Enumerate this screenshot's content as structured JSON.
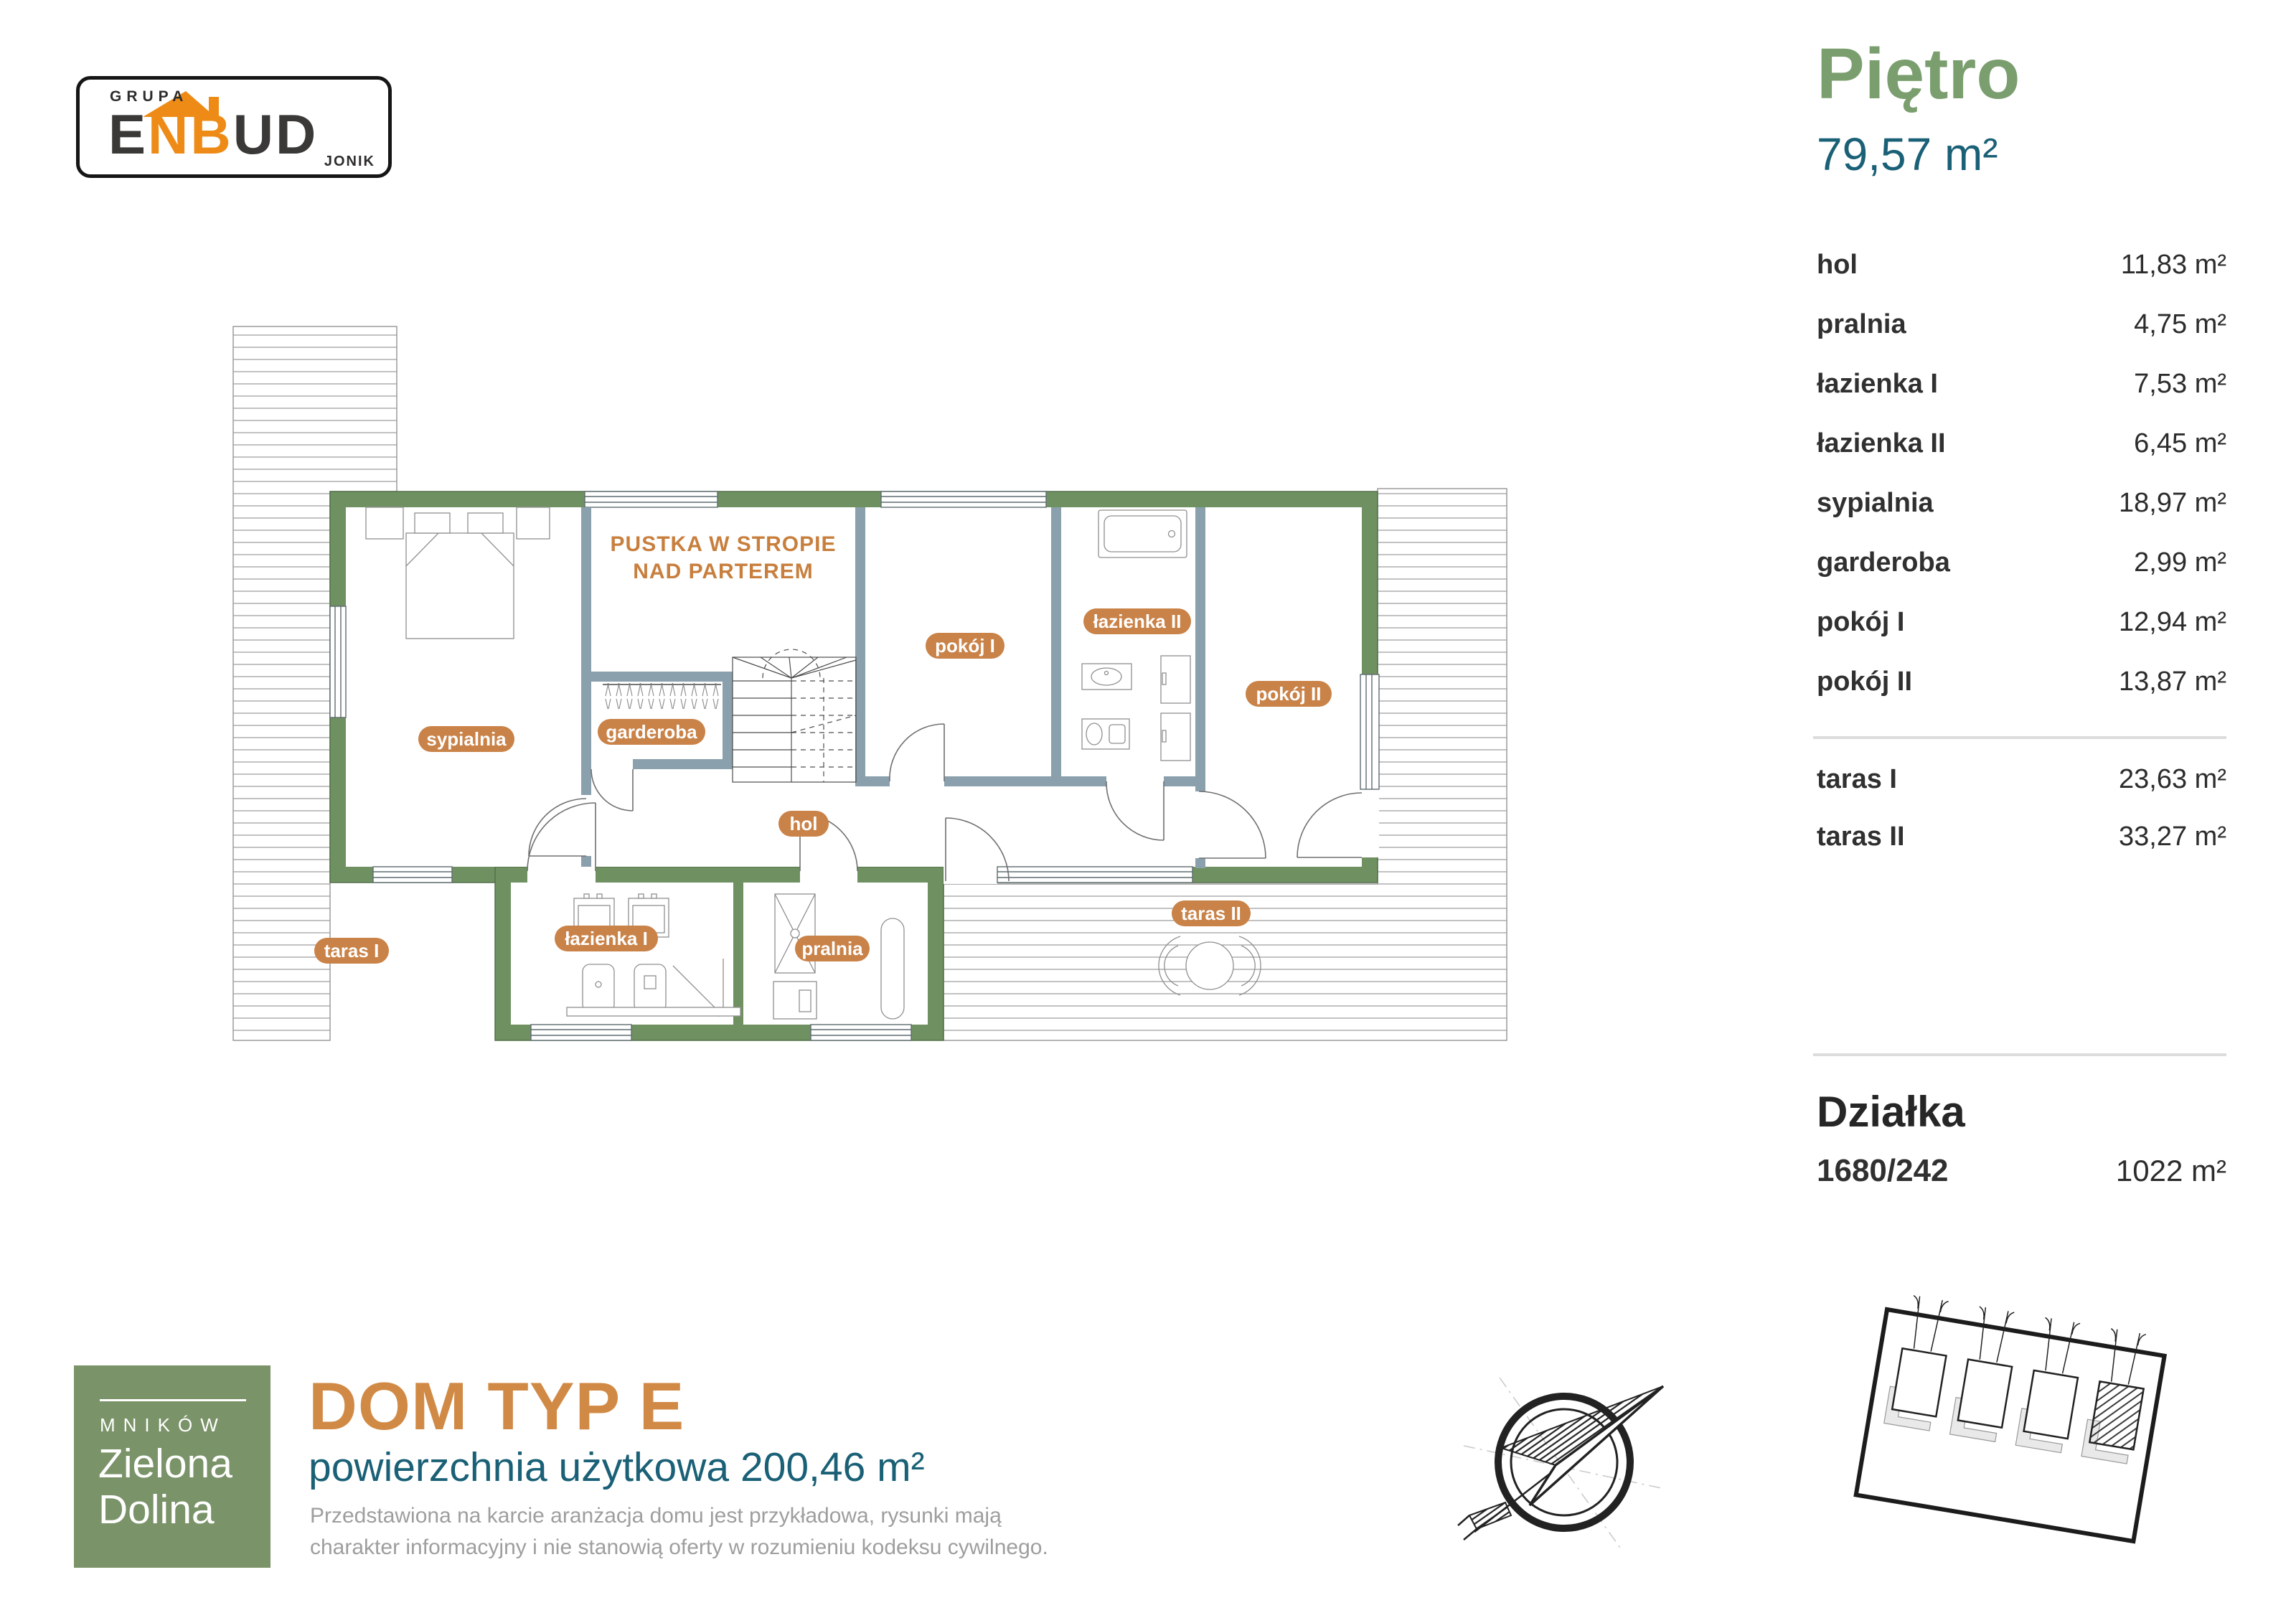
{
  "logo": {
    "grupa": "GRUPA",
    "dark1": "E",
    "orange": "NB",
    "dark2": "UD",
    "sub": "JONIK"
  },
  "header": {
    "title": "Piętro",
    "area": "79,57 m²"
  },
  "rooms": [
    {
      "label": "hol",
      "area": "11,83 m²"
    },
    {
      "label": "pralnia",
      "area": "4,75 m²"
    },
    {
      "label": "łazienka I",
      "area": "7,53 m²"
    },
    {
      "label": "łazienka II",
      "area": "6,45 m²"
    },
    {
      "label": "sypialnia",
      "area": "18,97 m²"
    },
    {
      "label": "garderoba",
      "area": "2,99 m²"
    },
    {
      "label": "pokój I",
      "area": "12,94 m²"
    },
    {
      "label": "pokój II",
      "area": "13,87 m²"
    }
  ],
  "terraces": [
    {
      "label": "taras I",
      "area": "23,63 m²"
    },
    {
      "label": "taras II",
      "area": "33,27 m²"
    }
  ],
  "plot": {
    "title": "Działka",
    "number": "1680/242",
    "area": "1022 m²"
  },
  "footer": {
    "location": "MNIKÓW",
    "brand1": "Zielona",
    "brand2": "Dolina",
    "title": "DOM TYP E",
    "subtitle": "powierzchnia użytkowa 200,46 m²",
    "disclaimer1": "Przedstawiona na karcie aranżacja domu jest przykładowa, rysunki mają",
    "disclaimer2": "charakter informacyjny i nie stanowią oferty w rozumieniu kodeksu cywilnego."
  },
  "plan": {
    "void1": "PUSTKA W STROPIE",
    "void2": "NAD PARTEREM",
    "labels": {
      "sypialnia": "sypialnia",
      "garderoba": "garderoba",
      "hol": "hol",
      "pokoj1": "pokój I",
      "lazienka2": "łazienka II",
      "pokoj2": "pokój II",
      "lazienka1": "łazienka I",
      "pralnia": "pralnia",
      "taras1": "taras I",
      "taras2": "taras II"
    }
  },
  "colors": {
    "wall_green": "#6f9161",
    "interior_wall": "#8aa0ac",
    "accent_orange": "#c98247",
    "heading_green": "#7a9e6e",
    "teal": "#1a6076",
    "title_orange": "#d18a45",
    "logo_orange": "#ee8b16"
  }
}
